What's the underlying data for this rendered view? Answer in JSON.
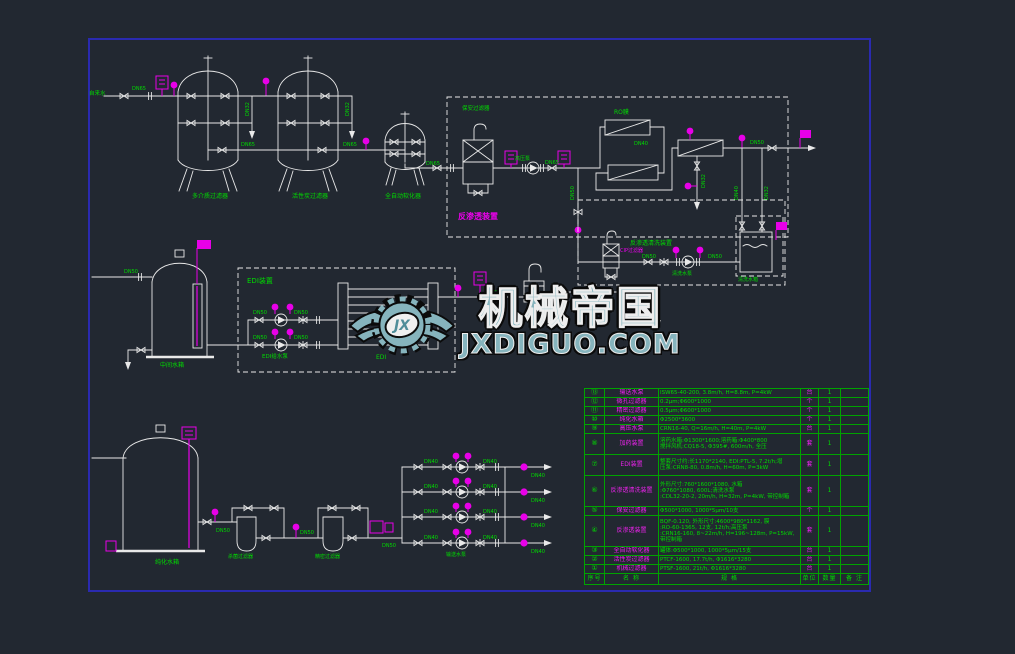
{
  "watermark": {
    "logo_text": "JX",
    "title": "机械帝国",
    "url": "JXDIGUO.COM"
  },
  "labels": {
    "tap_water": "自来水",
    "dn65": "DN65",
    "dn50": "DN50",
    "dn40": "DN40",
    "dn32": "DN32",
    "tank1": "多介质过滤器",
    "tank2": "活性炭过滤器",
    "tank3": "全自动软化器",
    "ro_unit": "反渗透装置",
    "guard_filter": "保安过滤器",
    "hp_pump": "高压泵",
    "ro_membrane": "RO膜",
    "cip_unit": "反渗透清洗装置",
    "cip_filter": "CIP过滤器",
    "cip_pump": "清洗水泵",
    "cip_tank": "清洗水箱",
    "mid_tank": "中间水箱",
    "edi_unit": "EDI装置",
    "edi_pump": "EDI给水泵",
    "edi": "EDI",
    "small_pure_tank": "纯水箱",
    "pure_tank": "纯化水箱",
    "sterile_filter": "杀菌过滤器",
    "fine_filter": "精密过滤器",
    "delivery_pump": "输送水泵"
  },
  "bom": {
    "headers": {
      "no": "序号",
      "name": "名 称",
      "spec": "规 格",
      "unit": "单位",
      "qty": "数量",
      "remark": "备 注"
    },
    "rows": [
      {
        "no": "⑬",
        "name": "输送水泵",
        "spec": "ISW65-40-200, 3.8m/h, H=8.8m, P=4kW",
        "unit": "台",
        "qty": "1",
        "remark": ""
      },
      {
        "no": "⑫",
        "name": "微孔过滤器",
        "spec": "0.2μm;Φ600*1000",
        "unit": "个",
        "qty": "1",
        "remark": ""
      },
      {
        "no": "⑪",
        "name": "精密过滤器",
        "spec": "0.5μm;Φ600*1000",
        "unit": "个",
        "qty": "1",
        "remark": ""
      },
      {
        "no": "⑩",
        "name": "纯化水箱",
        "spec": "Φ2500*3600",
        "unit": "个",
        "qty": "1",
        "remark": ""
      },
      {
        "no": "⑨",
        "name": "高压水泵",
        "spec": "CRN16-40, Q=16m/h, H=40m, P=4kW",
        "unit": "台",
        "qty": "1",
        "remark": ""
      },
      {
        "no": "⑧",
        "name": "加药装置",
        "spec": "溶药水箱:Φ1300*1600;溶药箱:Φ400*800\n搅拌风机:CQ18-5, Φ395#, 600m/h, 全压",
        "unit": "套",
        "qty": "1",
        "remark": ""
      },
      {
        "no": "⑦",
        "name": "EDI装置",
        "spec": "整套尺寸约:长1170*2140, EDI:PTL-5, 7.2t/h;增\n压泵:CRN8-80, 0.8m/h, H=60m, P=3kW",
        "unit": "套",
        "qty": "1",
        "remark": ""
      },
      {
        "no": "⑥",
        "name": "反渗透清洗装置",
        "spec": "外形尺寸:760*1600*1080, 水箱\n:Φ760*1080, 600L;清洗水泵\n:CDL32-20-2, 20m/h, H=32m, P=4kW, 带控制箱",
        "unit": "套",
        "qty": "1",
        "remark": ""
      },
      {
        "no": "⑤",
        "name": "保安过滤器",
        "spec": "Φ500*1000, 1000*5μm/10支",
        "unit": "个",
        "qty": "1",
        "remark": ""
      },
      {
        "no": "④",
        "name": "反渗透装置",
        "spec": "BQF-0.120, 外形尺寸:4600*980*1162, 膜\n:RO-60-1365, 12支, 12t/h;高压泵\n:CRN16-160, 8~22m/h, H=196~128m, P=15kW, 带控制箱",
        "unit": "套",
        "qty": "1",
        "remark": ""
      },
      {
        "no": "③",
        "name": "全自动软化器",
        "spec": "罐体:Φ500*1000, 1000*5μm/15支",
        "unit": "台",
        "qty": "1",
        "remark": ""
      },
      {
        "no": "②",
        "name": "活性炭过滤器",
        "spec": "PTCF-1600, 17.7t/h, Φ1616*3280",
        "unit": "台",
        "qty": "1",
        "remark": ""
      },
      {
        "no": "①",
        "name": "机械过滤器",
        "spec": "PTSF-1600, 21t/h, Φ1616*3280",
        "unit": "台",
        "qty": "1",
        "remark": ""
      }
    ]
  }
}
